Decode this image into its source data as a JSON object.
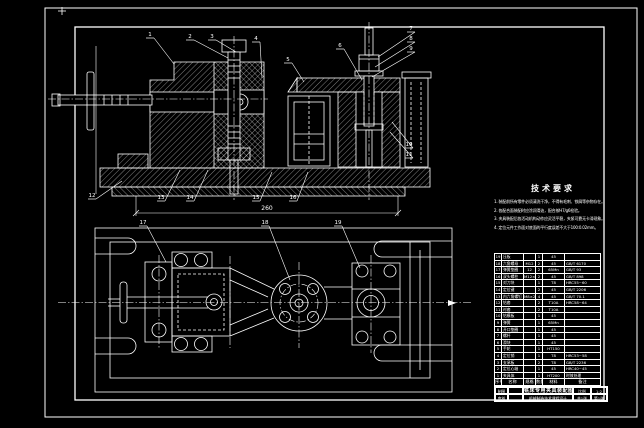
{
  "meta": {
    "background_color": "#000000",
    "line_color": "#ffffff",
    "drawing_type": "CAD assembly drawing, front section view and plan view of a machining fixture"
  },
  "tech_requirements": {
    "title": "技术要求",
    "items": [
      "1. 装配前所有零件必须清洗干净，不得有毛刺、铁屑等杂物存在。",
      "2. 各配合面装配时应涂润滑油，配合按H7/g6检验。",
      "3. 夹具装配后各活动机构动作应灵活平稳，夹紧可靠无卡滞现象。",
      "4. 定位元件工作面对底面的平行度误差不大于100:0.02mm。"
    ]
  },
  "callouts": {
    "labels": [
      "1",
      "2",
      "3",
      "4",
      "5",
      "6",
      "7",
      "8",
      "9",
      "10",
      "11",
      "12",
      "13",
      "14",
      "15",
      "16",
      "17",
      "18",
      "19"
    ]
  },
  "dimensions": {
    "front_overall": "260"
  },
  "parts_table": {
    "headers": [
      "序号",
      "名称",
      "规格",
      "数量",
      "材料",
      "备注"
    ],
    "rows": [
      [
        "19",
        "压板",
        "",
        "1",
        "45",
        ""
      ],
      [
        "18",
        "六角螺母",
        "M12",
        "2",
        "45",
        "GB/T 6170"
      ],
      [
        "17",
        "弹簧垫圈",
        "12",
        "2",
        "65Mn",
        "GB/T 93"
      ],
      [
        "16",
        "双头螺柱",
        "M12×60",
        "2",
        "45",
        "GB/T 898"
      ],
      [
        "15",
        "对刀块",
        "",
        "1",
        "T8",
        "HRC55~60"
      ],
      [
        "14",
        "定位键",
        "",
        "2",
        "45",
        "GB/T 2206"
      ],
      [
        "13",
        "内六角螺钉",
        "M8×20",
        "4",
        "45",
        "GB/T 70.1"
      ],
      [
        "12",
        "钻套",
        "",
        "2",
        "T10A",
        "HRC58~64"
      ],
      [
        "11",
        "衬套",
        "",
        "2",
        "T10A",
        ""
      ],
      [
        "10",
        "钻模板",
        "",
        "1",
        "45",
        ""
      ],
      [
        "9",
        "弹簧",
        "",
        "1",
        "65Mn",
        ""
      ],
      [
        "8",
        "开口垫圈",
        "",
        "1",
        "45",
        ""
      ],
      [
        "7",
        "螺杆",
        "",
        "1",
        "45",
        ""
      ],
      [
        "6",
        "滑块",
        "",
        "1",
        "45",
        ""
      ],
      [
        "5",
        "手轮",
        "",
        "1",
        "HT150",
        ""
      ],
      [
        "4",
        "定位销",
        "",
        "1",
        "T8",
        "HRC53~58"
      ],
      [
        "3",
        "支承板",
        "",
        "2",
        "T8",
        "GB/T 2236"
      ],
      [
        "2",
        "定位心轴",
        "",
        "1",
        "45",
        "HRC40~45"
      ],
      [
        "1",
        "夹具体",
        "",
        "1",
        "HT200",
        "时效处理"
      ]
    ]
  },
  "title_block": {
    "drawn_label": "制图",
    "checked_label": "审核",
    "title": "铣床专用夹具装配图",
    "course": "机械制造技术课程设计",
    "scale_label": "比例",
    "scale_value": "1:2",
    "sheet_label": "共1张",
    "page_label": "第1张"
  }
}
